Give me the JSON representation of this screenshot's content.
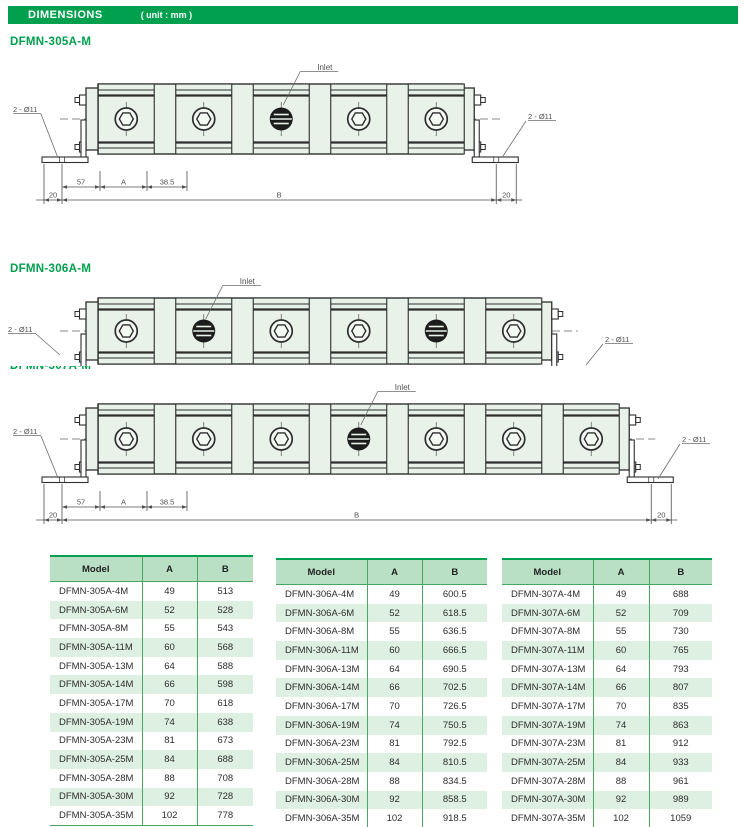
{
  "header": {
    "title": "DIMENSIONS",
    "unit": "( unit : mm )"
  },
  "colors": {
    "accent_green": "#00a04e",
    "table_line_green": "#4aa663",
    "table_header_bg": "#b9e0c4",
    "table_alt_row_bg": "#def0e1",
    "drawing_body_fill": "#e9f2e9",
    "drawing_line": "#2e2e2e"
  },
  "drawings": [
    {
      "title": "DFMN-305A-M",
      "sections": 5,
      "inlets": [
        2
      ],
      "inlet_target": 2,
      "inlet_label": "Inlet",
      "hole_label_left": "2 - Ø11",
      "hole_label_right": "2 - Ø11",
      "dims": {
        "seg1": "57",
        "seg2": "A",
        "seg3": "38.5",
        "end_left": "20",
        "span": "B",
        "end_right": "20"
      }
    },
    {
      "title": "DFMN-306A-M",
      "sections": 6,
      "inlets": [
        1,
        4
      ],
      "inlet_target": 1,
      "inlet_label": "Inlet",
      "hole_label_left": "2 - Ø11",
      "hole_label_right": "2 - Ø11",
      "dims": null
    },
    {
      "title": "DFMN-307A-M",
      "sections": 7,
      "inlets": [
        3
      ],
      "inlet_target": 3,
      "inlet_label": "Inlet",
      "hole_label_left": "2 - Ø11",
      "hole_label_right": "2 - Ø11",
      "dims": {
        "seg1": "57",
        "seg2": "A",
        "seg3": "38.5",
        "end_left": "20",
        "span": "B",
        "end_right": "20"
      }
    }
  ],
  "tables": [
    {
      "headers": [
        "Model",
        "A",
        "B"
      ],
      "rows": [
        [
          "DFMN-305A-4M",
          "49",
          "513"
        ],
        [
          "DFMN-305A-6M",
          "52",
          "528"
        ],
        [
          "DFMN-305A-8M",
          "55",
          "543"
        ],
        [
          "DFMN-305A-11M",
          "60",
          "568"
        ],
        [
          "DFMN-305A-13M",
          "64",
          "588"
        ],
        [
          "DFMN-305A-14M",
          "66",
          "598"
        ],
        [
          "DFMN-305A-17M",
          "70",
          "618"
        ],
        [
          "DFMN-305A-19M",
          "74",
          "638"
        ],
        [
          "DFMN-305A-23M",
          "81",
          "673"
        ],
        [
          "DFMN-305A-25M",
          "84",
          "688"
        ],
        [
          "DFMN-305A-28M",
          "88",
          "708"
        ],
        [
          "DFMN-305A-30M",
          "92",
          "728"
        ],
        [
          "DFMN-305A-35M",
          "102",
          "778"
        ]
      ]
    },
    {
      "headers": [
        "Model",
        "A",
        "B"
      ],
      "rows": [
        [
          "DFMN-306A-4M",
          "49",
          "600.5"
        ],
        [
          "DFMN-306A-6M",
          "52",
          "618.5"
        ],
        [
          "DFMN-306A-8M",
          "55",
          "636.5"
        ],
        [
          "DFMN-306A-11M",
          "60",
          "666.5"
        ],
        [
          "DFMN-306A-13M",
          "64",
          "690.5"
        ],
        [
          "DFMN-306A-14M",
          "66",
          "702.5"
        ],
        [
          "DFMN-306A-17M",
          "70",
          "726.5"
        ],
        [
          "DFMN-306A-19M",
          "74",
          "750.5"
        ],
        [
          "DFMN-306A-23M",
          "81",
          "792.5"
        ],
        [
          "DFMN-306A-25M",
          "84",
          "810.5"
        ],
        [
          "DFMN-306A-28M",
          "88",
          "834.5"
        ],
        [
          "DFMN-306A-30M",
          "92",
          "858.5"
        ],
        [
          "DFMN-306A-35M",
          "102",
          "918.5"
        ]
      ]
    },
    {
      "headers": [
        "Model",
        "A",
        "B"
      ],
      "rows": [
        [
          "DFMN-307A-4M",
          "49",
          "688"
        ],
        [
          "DFMN-307A-6M",
          "52",
          "709"
        ],
        [
          "DFMN-307A-8M",
          "55",
          "730"
        ],
        [
          "DFMN-307A-11M",
          "60",
          "765"
        ],
        [
          "DFMN-307A-13M",
          "64",
          "793"
        ],
        [
          "DFMN-307A-14M",
          "66",
          "807"
        ],
        [
          "DFMN-307A-17M",
          "70",
          "835"
        ],
        [
          "DFMN-307A-19M",
          "74",
          "863"
        ],
        [
          "DFMN-307A-23M",
          "81",
          "912"
        ],
        [
          "DFMN-307A-25M",
          "84",
          "933"
        ],
        [
          "DFMN-307A-28M",
          "88",
          "961"
        ],
        [
          "DFMN-307A-30M",
          "92",
          "989"
        ],
        [
          "DFMN-307A-35M",
          "102",
          "1059"
        ]
      ]
    }
  ]
}
